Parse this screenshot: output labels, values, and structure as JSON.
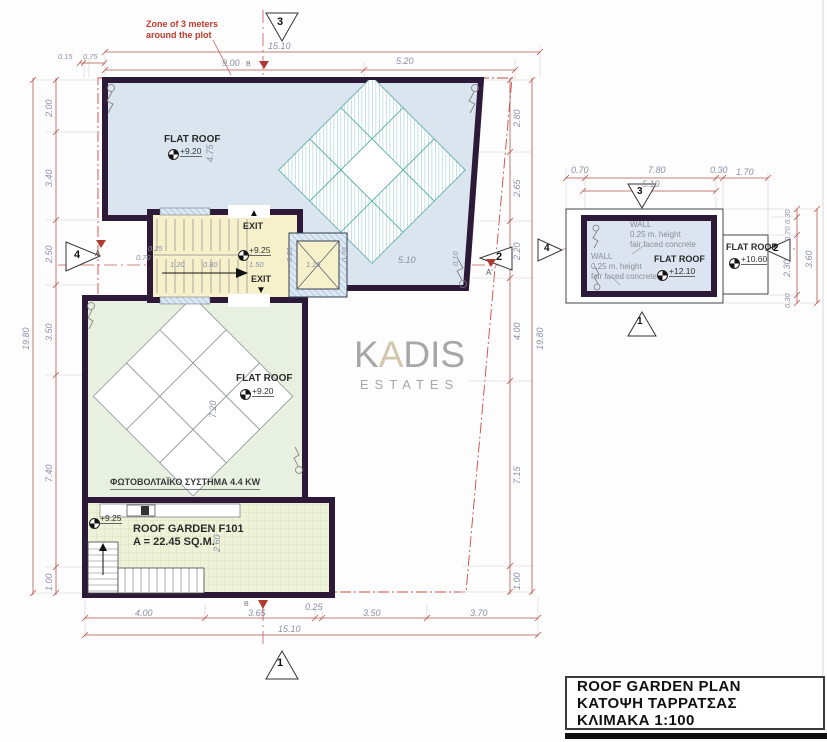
{
  "colors": {
    "wall": "#2c1a38",
    "roof_blue": "#dbe5ef",
    "roof_green": "#e8f0e1",
    "stair_yellow": "#f6f1ca",
    "garden": "#eef2d9",
    "dim_red": "#b5574d",
    "zone_red": "#cc4b44",
    "panel_teal": "#57aaa4",
    "watermark_gray": "#a7a7a7",
    "watermark_tan": "#d3c7ad"
  },
  "zone_note": {
    "line1": "Zone of 3 meters",
    "line2": "around the plot"
  },
  "watermark": {
    "k": "K",
    "a": "A",
    "dis": "DIS",
    "sub": "ESTATES"
  },
  "title_block": {
    "line1": "ROOF GARDEN PLAN",
    "line2": "ΚΑΤΟΨΗ ΤΑΡΡΑΤΣΑΣ",
    "line3": "ΚΛΙΜΑΚΑ 1:100"
  },
  "main_plan": {
    "markers": {
      "top": "3",
      "bottom": "1",
      "left": "4",
      "right": "2"
    },
    "grid": {
      "top": "B",
      "bottom": "B",
      "section_left": "A",
      "section_right": "A'"
    },
    "labels": {
      "flat_roof_upper": "FLAT ROOF",
      "flat_roof_upper_level": "+9.20",
      "flat_roof_lower": "FLAT ROOF",
      "flat_roof_lower_level": "+9.20",
      "stair_level": "+9.25",
      "exit_top": "EXIT",
      "exit_bottom": "EXIT",
      "exit_top_arrow": "▲",
      "exit_bottom_arrow": "▼",
      "garden_level": "+9.25",
      "garden_name": "ROOF GARDEN F101",
      "garden_area": "A = 22.45 SQ.M.",
      "pv": "ΦΩΤΟΒΟΛΤΑΪΚΟ ΣΥΣΤΗΜΑ 4.4 KW"
    },
    "dims": {
      "top_total": "15.10",
      "top_a": "9.00",
      "top_b": "5.20",
      "tiny_a": "0.15",
      "tiny_b": "0.75",
      "left": [
        "2.00",
        "3.40",
        "2.50",
        "3.50",
        "7.40",
        "1.00"
      ],
      "left_total": "19.80",
      "right": [
        "2.80",
        "2.65",
        "2.20",
        "4.00",
        "7.15",
        "1.00"
      ],
      "right_total": "19.80",
      "bottom": [
        "4.00",
        "3.65",
        "0.25",
        "3.50",
        "3.70"
      ],
      "bottom_total": "15.10",
      "stair_a": "0.25",
      "stair_b": "0.70",
      "stair_c": "1.20",
      "stair_d": "0.80",
      "stair_e": "1.50",
      "sky_a": "0.20",
      "sky_b": "1.25",
      "sky_c": "0.20",
      "run": "5.10",
      "end": "0.10",
      "h_upper": "4.75",
      "h_pv": "7.20",
      "h_garden": "2.60"
    }
  },
  "small_plan": {
    "markers": {
      "top": "3",
      "bottom": "1",
      "left": "4",
      "right": "2"
    },
    "labels": {
      "wall_note_1": [
        "WALL",
        "0.25 m. height",
        "fair faced concrete"
      ],
      "wall_note_2": [
        "WALL",
        "0.25 m. height",
        "fair faced concrete"
      ],
      "flat_roof_main": "FLAT ROOF",
      "flat_roof_main_level": "+12.10",
      "flat_roof_ext": "FLAT ROOF",
      "flat_roof_ext_level": "+10.60"
    },
    "dims": {
      "top": [
        "0.70",
        "7.80",
        "0.30",
        "1.70"
      ],
      "inner": "5.10",
      "right": [
        "0.30",
        "0.70",
        "2.30",
        "0.30"
      ],
      "right_total": "3.60"
    }
  }
}
